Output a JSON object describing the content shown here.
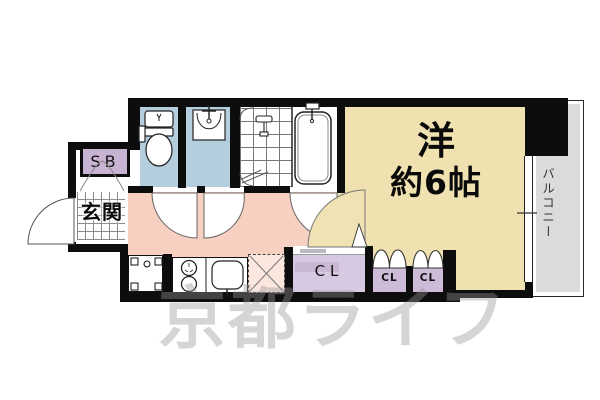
{
  "floor_plan": {
    "rooms": {
      "main_room": {
        "label_line1": "洋",
        "label_line2": "約6帖"
      },
      "balcony": {
        "label": "バルコニー"
      },
      "entrance": {
        "label": "玄関"
      },
      "shoe_box": {
        "label": "SB"
      },
      "closet_large": {
        "label": "CL"
      },
      "closet_small_1": {
        "label": "CL"
      },
      "closet_small_2": {
        "label": "CL"
      }
    },
    "fixtures": [
      "toilet",
      "washbasin",
      "shower",
      "bathtub",
      "stove",
      "kitchen-sink",
      "refrigerator-space",
      "washer-space"
    ],
    "watermark": "京都ライフ",
    "colors": {
      "main_room": "#F0E2B0",
      "hallway_kitchen": "#F8D0C1",
      "wet_rooms": "#B5CEDE",
      "closets": "#D8C9E2",
      "balcony": "#DBDBDB",
      "walls": "#0D0D0D",
      "watermark": "#98949A"
    }
  }
}
